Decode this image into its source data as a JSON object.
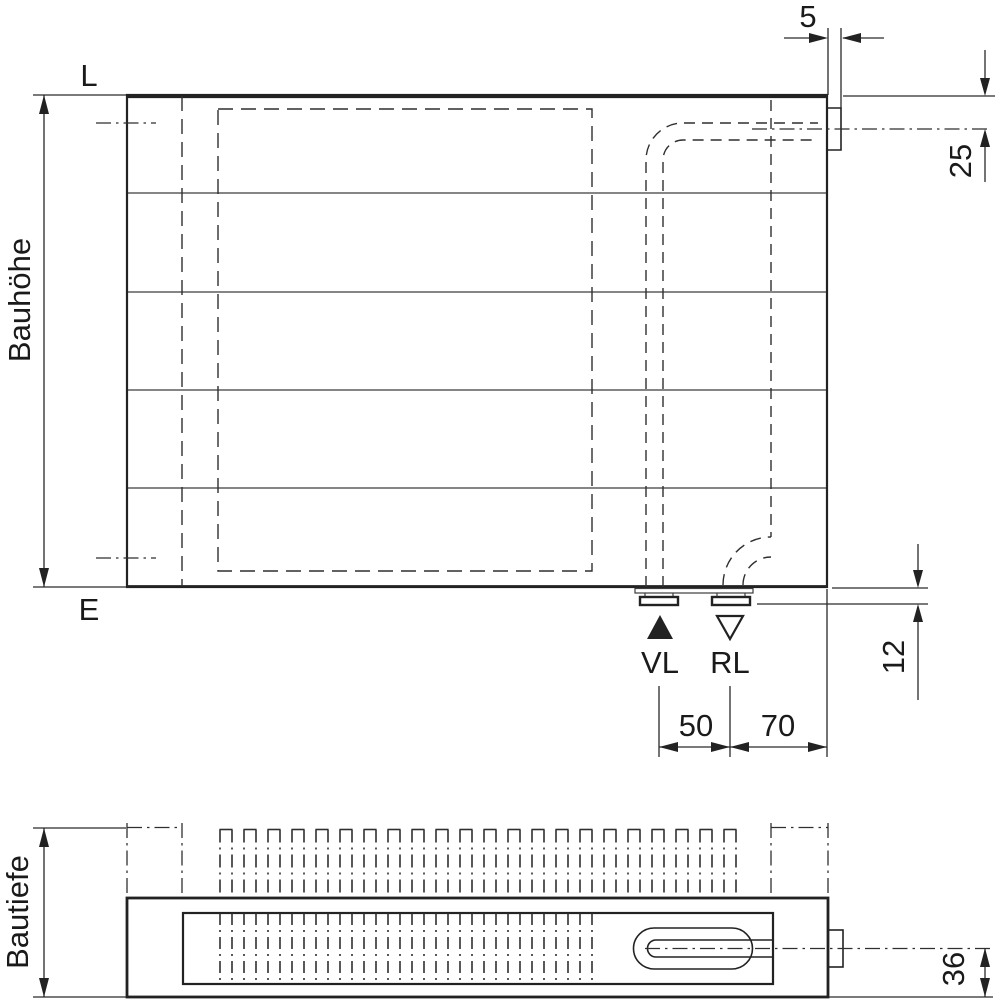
{
  "front_view": {
    "corner_label_top": "L",
    "corner_label_bottom": "E",
    "height_dim_label": "Bauhöhe",
    "tab_width_dim": "5",
    "tab_center_dim": "25",
    "bottom_connection_dim": "12",
    "supply_label": "VL",
    "return_label": "RL",
    "supply_return_spacing_dim": "50",
    "return_edge_spacing_dim": "70"
  },
  "plan_view": {
    "depth_dim_label": "Bautiefe",
    "pipe_axis_dim": "36"
  },
  "colors": {
    "line": "#222222",
    "thin_line": "#3c3c3c",
    "text": "#1a1a1a",
    "background": "#ffffff"
  }
}
